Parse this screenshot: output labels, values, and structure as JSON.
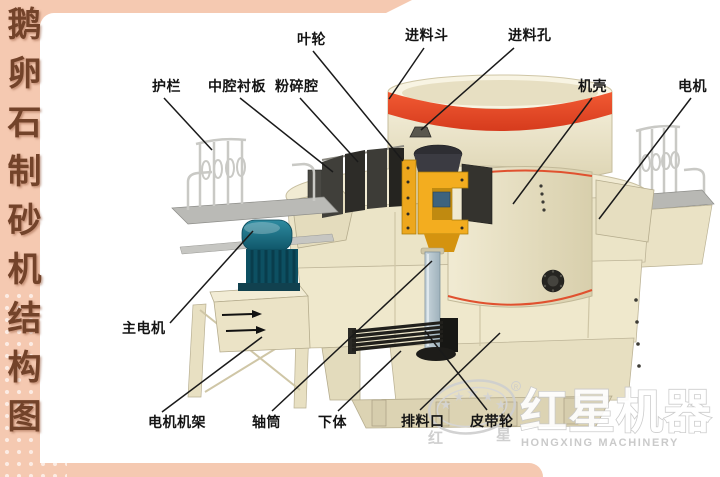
{
  "sidebar": {
    "title": "鹅卵石制砂机结构图"
  },
  "labels": {
    "impeller": "叶轮",
    "feed_hopper": "进料斗",
    "feed_hole": "进料孔",
    "guardrail": "护栏",
    "cavity_liner": "中腔衬板",
    "crushing_chamber": "粉碎腔",
    "casing": "机壳",
    "motor": "电机",
    "main_motor": "主电机",
    "motor_frame": "电机机架",
    "shaft_tube": "轴筒",
    "lower_body": "下体",
    "discharge_port": "排料口",
    "belt_pulley": "皮带轮"
  },
  "watermark": {
    "brand_cn": "红星机器",
    "brand_en": "HONGXING MACHINERY",
    "seal_left_char": "红",
    "seal_right_char": "星",
    "registered_mark": "R",
    "star_glyph": "★"
  },
  "colors": {
    "frame_salmon": "#f5c9b1",
    "sidebar_text_brown": "#73432a",
    "label_black": "#141414",
    "hopper_band_red": "#e8472b",
    "hub_yellow": "#f3ad1f",
    "motor_teal": "#196a7e",
    "body_cream": "#efe8cd",
    "watermark_gray": "#c9c9c9"
  }
}
